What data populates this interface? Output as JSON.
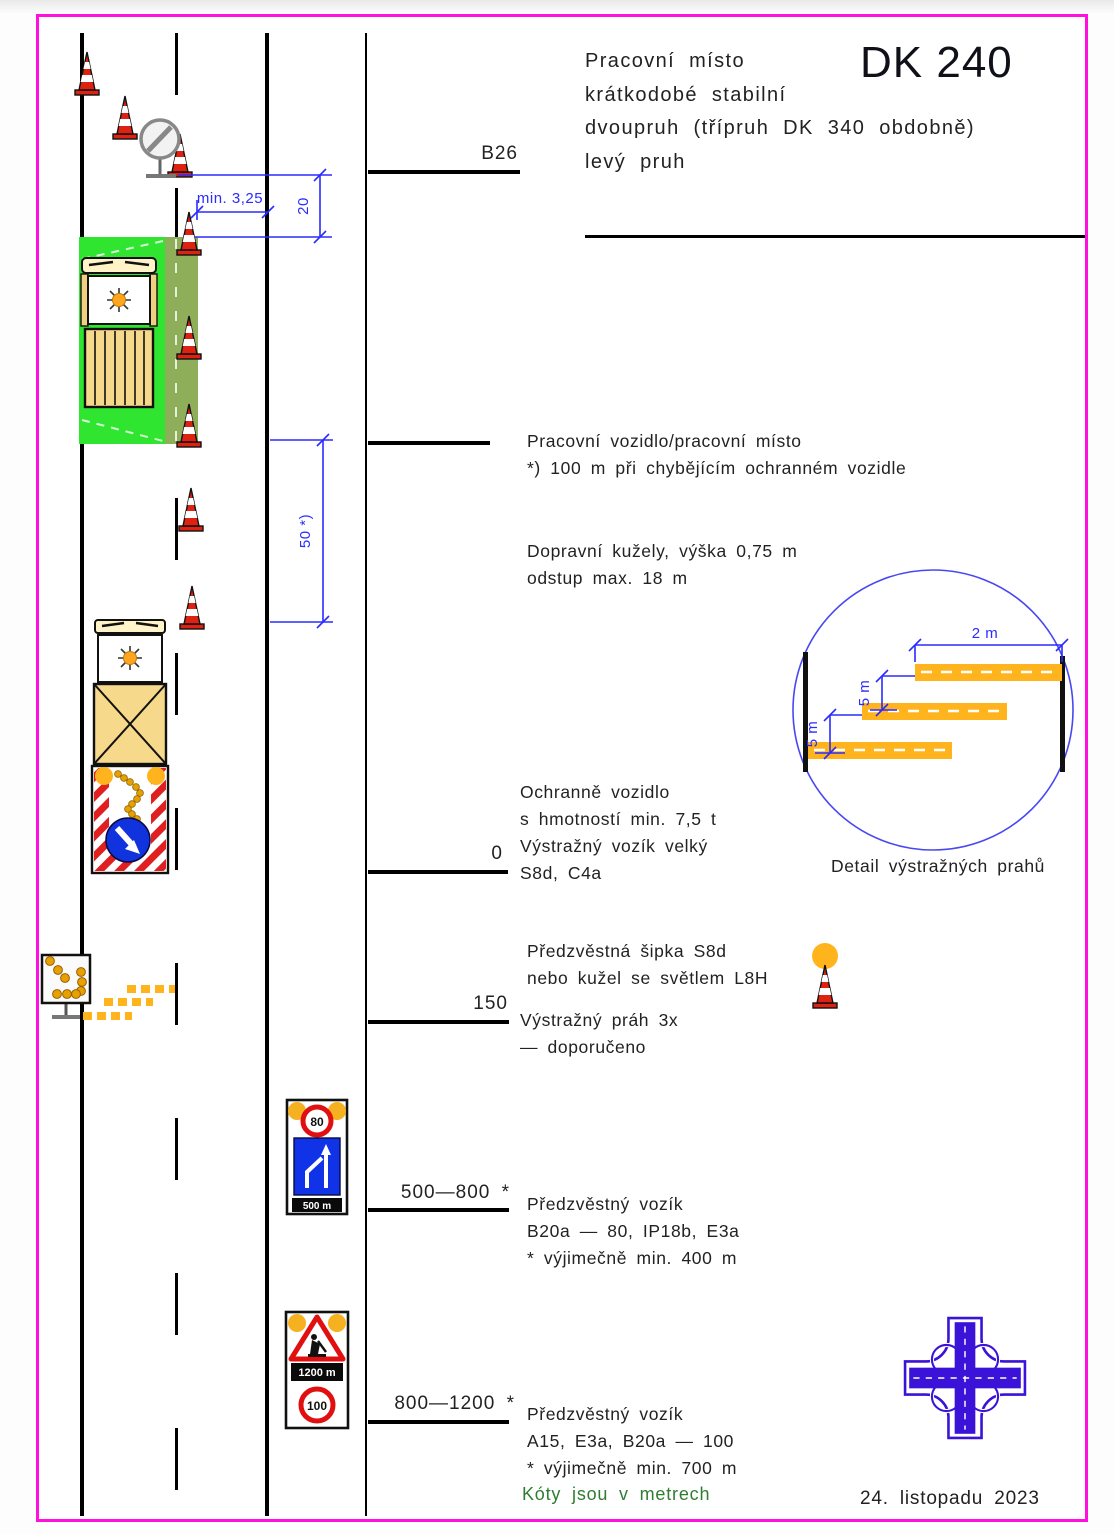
{
  "title": {
    "code": "DK 240",
    "lines": [
      "Pracovní místo",
      "krátkodobé stabilní",
      "dvoupruh (třípruh DK 340 obdobně)",
      "levý pruh"
    ]
  },
  "stations": {
    "b26": "B26",
    "zero": "0",
    "s150": "150",
    "s500_800": "500—800 *",
    "s800_1200": "800—1200 *"
  },
  "dims": {
    "min_lane": "min. 3,25",
    "d20": "20",
    "d50": "50 *)",
    "d2m": "2 m",
    "d5m_upper": "5 m",
    "d5m_lower": "5 m"
  },
  "notes": {
    "work_place": [
      "Pracovní vozidlo/pracovní místo",
      "*) 100 m při chybějícím ochranném vozidle"
    ],
    "cones": [
      "Dopravní kužely, výška 0,75 m",
      "odstup max. 18 m"
    ],
    "guard": [
      "Ochranně vozidlo",
      "s hmotností min. 7,5 t",
      "Výstražný vozík velký",
      "S8d, C4a"
    ],
    "arrow": [
      "Předzvěstná šipka S8d",
      "nebo kužel se světlem L8H"
    ],
    "threshold": [
      "Výstražný práh 3x",
      "— doporučeno"
    ],
    "advance1": [
      "Předzvěstný vozík",
      "B20a — 80, IP18b, E3a",
      "* výjimečně min. 400 m"
    ],
    "advance2": [
      "Předzvěstný vozík",
      "A15, E3a, B20a — 100",
      "* výjimečně min. 700 m"
    ]
  },
  "signs": {
    "speed80": "80",
    "speed100": "100",
    "plate1": "500 m",
    "plate2": "1200 m"
  },
  "detail": {
    "caption": "Detail výstražných prahů"
  },
  "footer": {
    "units_note": "Kóty jsou v metrech",
    "date": "24. listopadu 2023"
  },
  "colors": {
    "frame_magenta": "#ff10df",
    "dimension_blue": "#2b2bff",
    "work_green": "#2fe52f",
    "shoulder_olive": "#8fae5a",
    "warning_orange": "#ffb41e",
    "cone_red": "#dd2211",
    "sign_blue": "#1133e8",
    "logo_blue": "#3a12d8",
    "note_green": "#2f7d32"
  }
}
